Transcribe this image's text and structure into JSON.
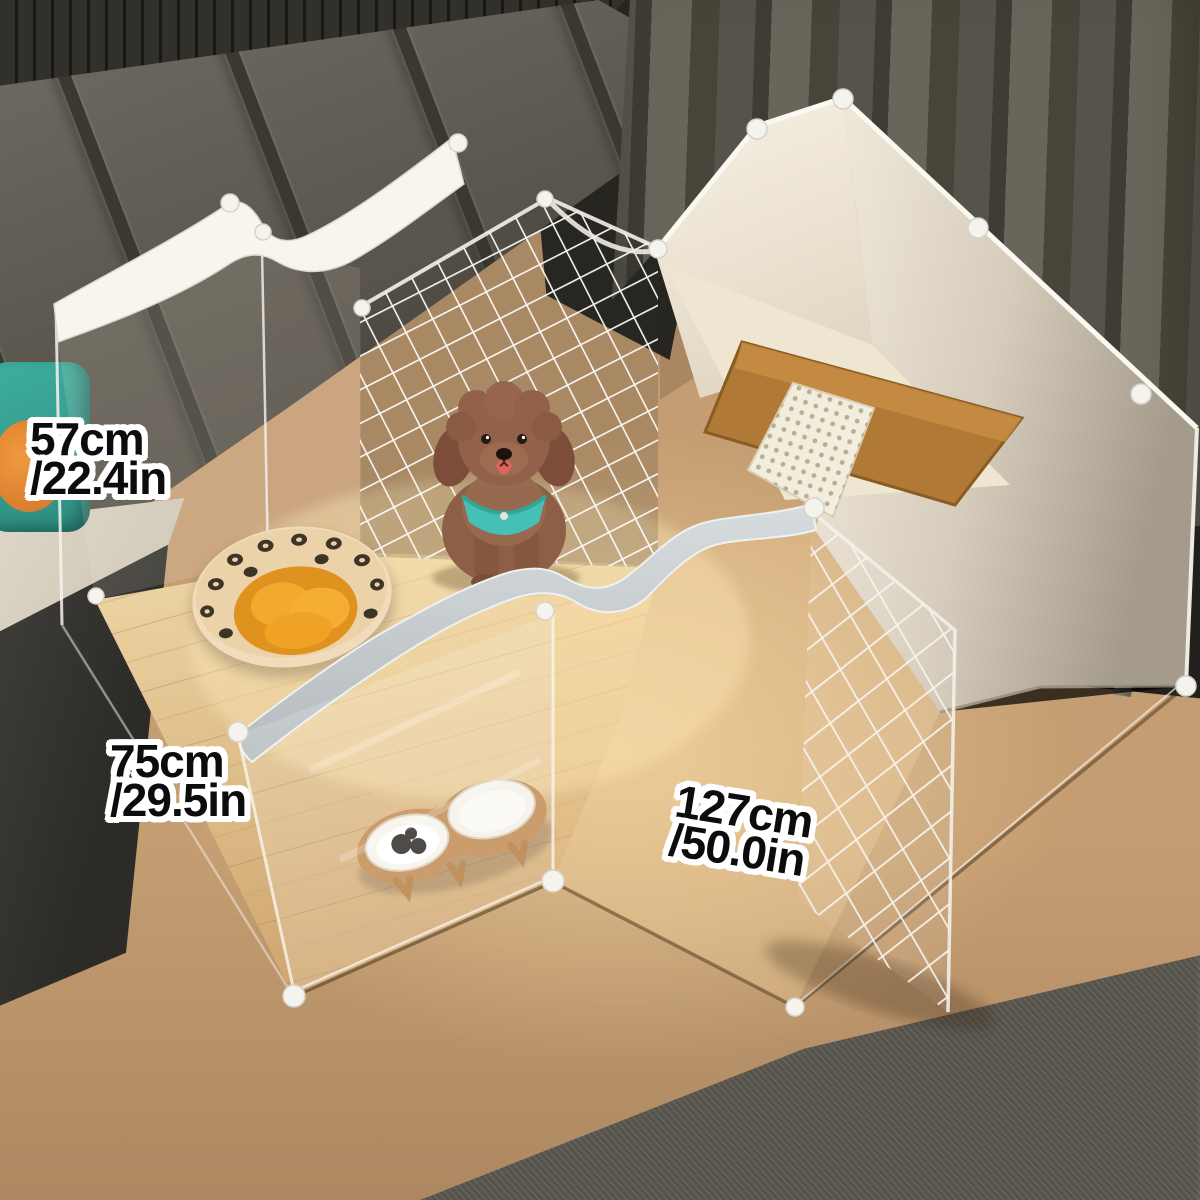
{
  "image": {
    "type": "product-photo",
    "subject": "Transparent DIY pet playpen (dog fence) with open wire-mesh door, photographed from above in a living room with a toy poodle inside",
    "setting": [
      "grey padded headboard wall",
      "dark olive curtains",
      "oak wood floor",
      "dark grey rug",
      "dark TV cabinet"
    ]
  },
  "dimension_labels": {
    "height": {
      "metric": "57cm",
      "imperial": "/22.4in"
    },
    "depth": {
      "metric": "75cm",
      "imperial": "/29.5in"
    },
    "width": {
      "metric": "127cm",
      "imperial": "/50.0in"
    }
  },
  "scene_items": {
    "dog": "brown toy poodle wearing a teal harness, tongue out",
    "pet_bed": "round leopard-print bolster bed with orange tufted cushion",
    "feeder": "elevated wooden double-bowl feeder, one white bowl with dark kibble, one with milk",
    "litter_tray": "brown litter tray with white perforated grid",
    "mesh_panels": "white wire grid panel at back and a wire door swung open at front right",
    "connectors": "round white panel connector clips"
  },
  "palette": {
    "floor_wood": "#c59d72",
    "rug": "#5b5850",
    "curtain": "#56544a",
    "headboard": "#6e6960",
    "pen_white": "#f6f3ec",
    "divider_grey": "#c3c9cc",
    "cushion_orange": "#f3a82e",
    "bed_cream": "#f0dcba",
    "harness_teal": "#46c0b4",
    "dog_brown": "#8d5f46",
    "tray_brown": "#b07a36",
    "label_text": "#0c0c0c",
    "label_outline": "#ffffff"
  }
}
